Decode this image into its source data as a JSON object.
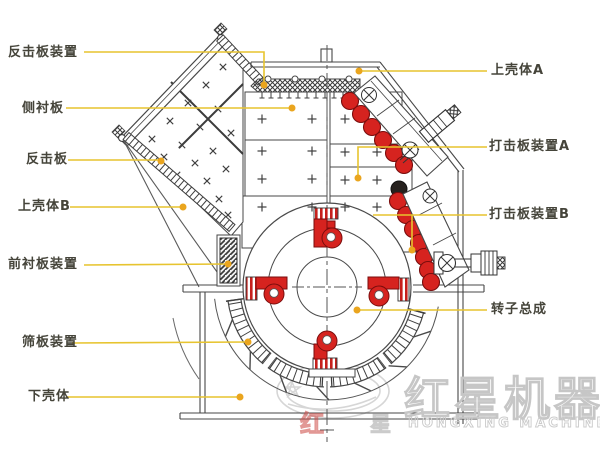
{
  "labels": {
    "left": [
      {
        "text": "反击板装置"
      },
      {
        "text": "侧衬板"
      },
      {
        "text": "反击板"
      },
      {
        "text": "上壳体B"
      },
      {
        "text": "前衬板装置"
      },
      {
        "text": "筛板装置"
      },
      {
        "text": "下壳体"
      }
    ],
    "right": [
      {
        "text": "上壳体A"
      },
      {
        "text": "打击板装置A"
      },
      {
        "text": "打击板装置B"
      },
      {
        "text": "转子总成"
      }
    ]
  },
  "watermark": {
    "brand_cn": "红星机器",
    "brand_en": "HONGXING MACHINERY",
    "ghost": [
      "红",
      "星"
    ]
  },
  "colors": {
    "leader_line": "#e7c42f",
    "leader_dot": "#eaa51e",
    "part_red": "#d6231f",
    "line": "#474747",
    "watermark_gray": "#c9c9c9"
  }
}
